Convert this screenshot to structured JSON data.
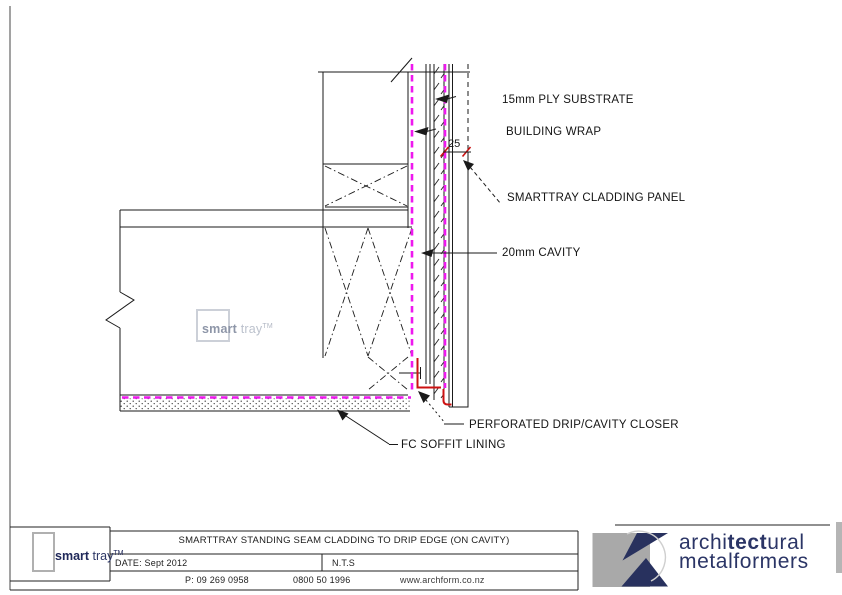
{
  "drawing": {
    "labels": {
      "ply_substrate": "15mm PLY SUBSTRATE",
      "building_wrap": "BUILDING WRAP",
      "cladding_panel": "SMARTTRAY CLADDING PANEL",
      "cavity": "20mm CAVITY",
      "drip_closer": "PERFORATED DRIP/CAVITY CLOSER",
      "soffit_lining": "FC SOFFIT LINING",
      "seam_dimension": "25"
    },
    "watermark": {
      "brand_bold": "smart",
      "brand_light": " tray",
      "tm": "TM"
    },
    "colors": {
      "magenta": "#ee18ee",
      "red": "#cc1111",
      "line": "#1a1a1a"
    }
  },
  "title_block": {
    "logo": {
      "bold": "smart",
      "light": " tray",
      "tm": "TM"
    },
    "title": "SMARTTRAY STANDING SEAM CLADDING TO DRIP EDGE (ON CAVITY)",
    "date": "DATE: Sept 2012",
    "scale": "N.T.S",
    "phone": "P: 09 269 0958",
    "freephone": "0800 50 1996",
    "website": "www.archform.co.nz"
  },
  "am_logo": {
    "line1_pre": "archi",
    "line1_bold": "tect",
    "line1_post": "ural",
    "line2": "metalformers",
    "navy": "#2b3566",
    "gray": "#a9a9a9"
  }
}
